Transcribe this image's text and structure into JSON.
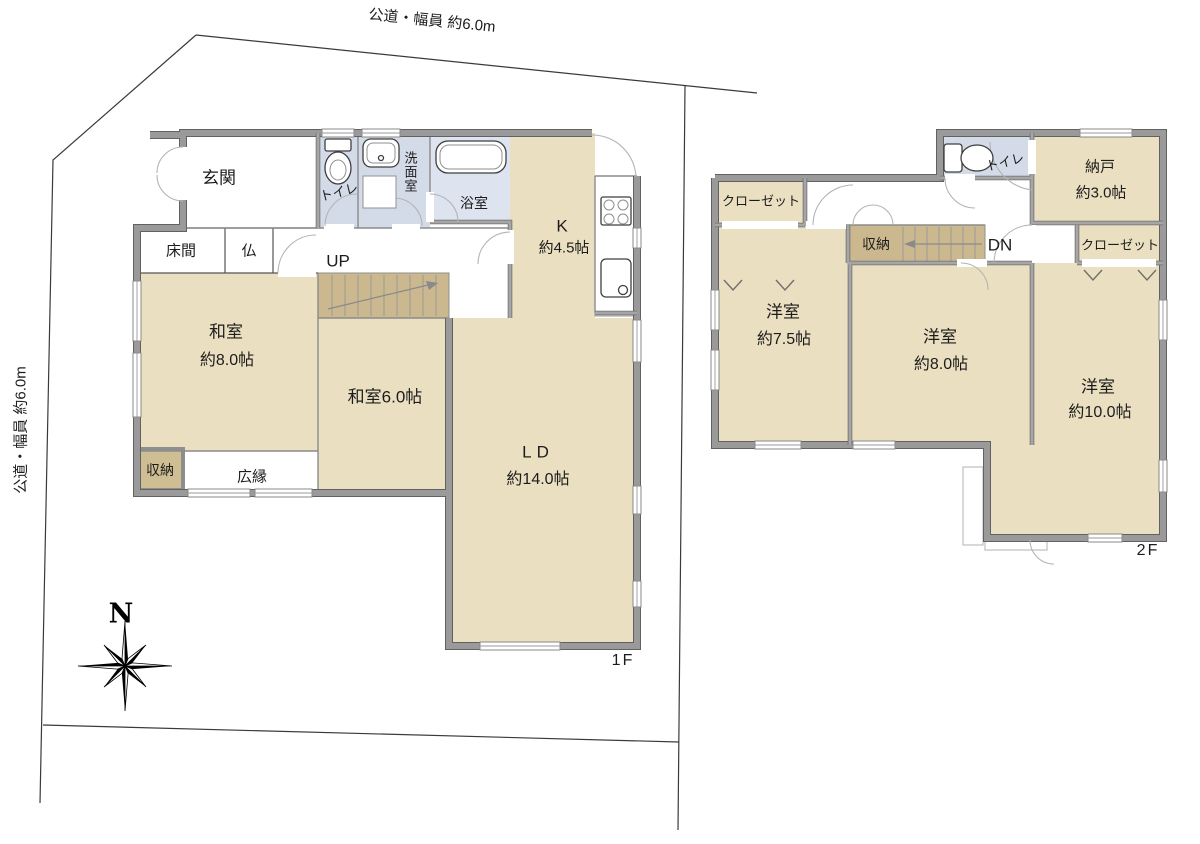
{
  "site": {
    "road_top_label": "公道・幅員 約6.0m",
    "road_left_label": "公道・幅員 約6.0m",
    "compass_north_label": "N"
  },
  "floor1": {
    "floor_label": "1F",
    "genkan": "玄関",
    "toilet": "トイレ",
    "washroom": "洗面室",
    "bathroom": "浴室",
    "kitchen_name": "K",
    "kitchen_size": "約4.5帖",
    "tokonoma": "床間",
    "butsuma": "仏",
    "stairs_up": "UP",
    "washitsu8_name": "和室",
    "washitsu8_size": "約8.0帖",
    "washitsu6": "和室6.0帖",
    "storage": "収納",
    "hiroen": "広縁",
    "living_name": "LD",
    "living_size": "約14.0帖"
  },
  "floor2": {
    "floor_label": "2F",
    "closet_left": "クローゼット",
    "toilet": "トイレ",
    "nando_name": "納戸",
    "nando_size": "約3.0帖",
    "storage": "収納",
    "stairs_down": "DN",
    "closet_right": "クローゼット",
    "yoshitsu75_name": "洋室",
    "yoshitsu75_size": "約7.5帖",
    "yoshitsu8_name": "洋室",
    "yoshitsu8_size": "約8.0帖",
    "yoshitsu10_name": "洋室",
    "yoshitsu10_size": "約10.0帖"
  },
  "colors": {
    "room_fill": "#EADFC0",
    "wet_room_fill": "#D4DBE8",
    "bath_fill": "#DDE3EF",
    "stairs_fill": "#CBB88E",
    "storage_fill": "#CFBD93",
    "wall": "#9A9A9A",
    "wall_edge": "#616161",
    "boundary_line": "#3A3A3A"
  }
}
